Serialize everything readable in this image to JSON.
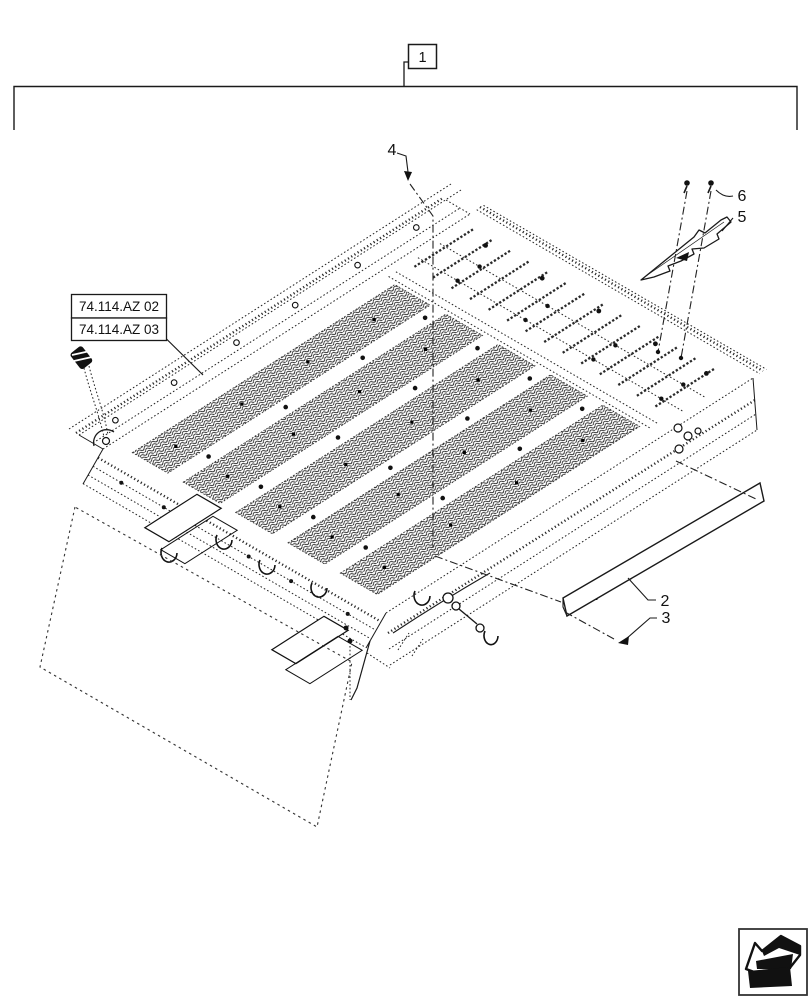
{
  "diagram_title_box": {
    "label": "1"
  },
  "reference_boxes": [
    {
      "label": "74.114.AZ 02"
    },
    {
      "label": "74.114.AZ 03"
    }
  ],
  "callouts": [
    {
      "id": "2"
    },
    {
      "id": "3"
    },
    {
      "id": "4"
    },
    {
      "id": "5"
    },
    {
      "id": "6"
    }
  ],
  "nav_icon": {
    "name": "back-arrow-icon"
  },
  "colors": {
    "line": "#1a1a1a",
    "background": "#ffffff"
  }
}
